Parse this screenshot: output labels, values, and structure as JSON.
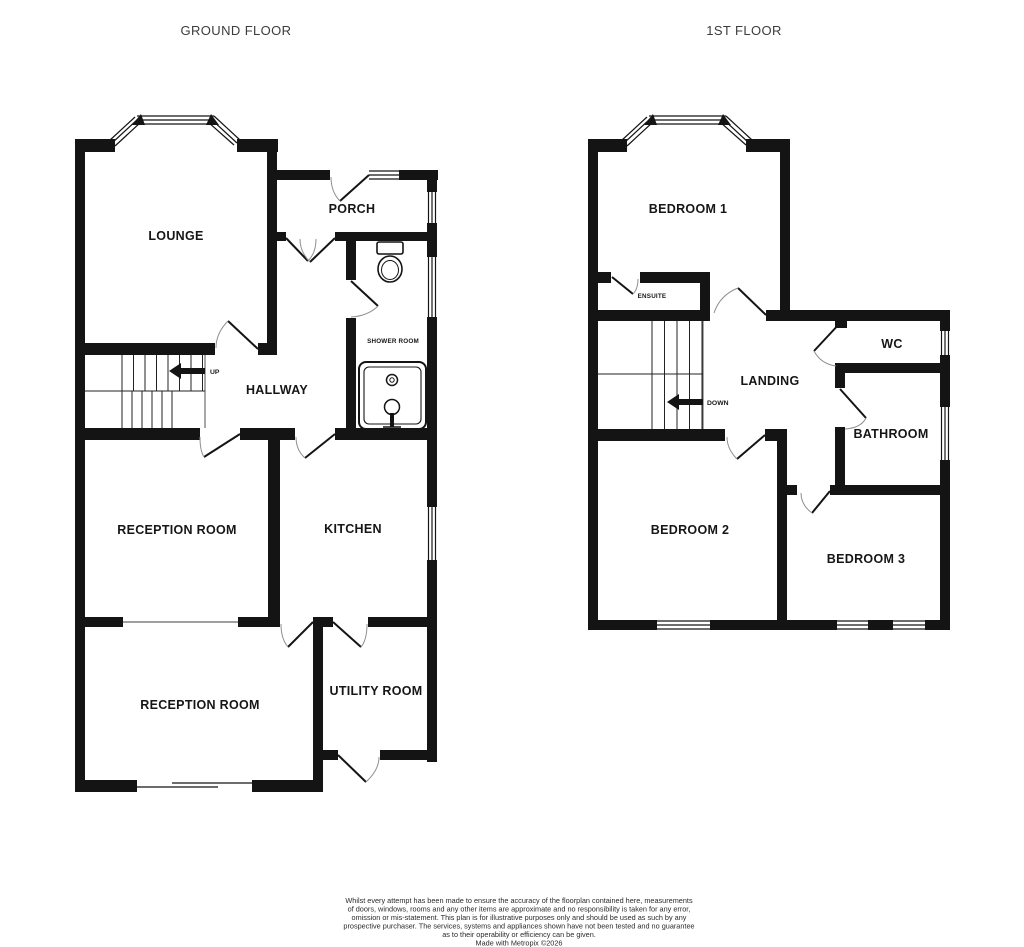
{
  "ground_floor": {
    "title": "GROUND FLOOR",
    "rooms": {
      "lounge": "LOUNGE",
      "porch": "PORCH",
      "hallway": "HALLWAY",
      "shower_room": "SHOWER ROOM",
      "reception_room_1": "RECEPTION ROOM",
      "kitchen": "KITCHEN",
      "reception_room_2": "RECEPTION ROOM",
      "utility_room": "UTILITY ROOM"
    },
    "stairs_label": "UP"
  },
  "first_floor": {
    "title": "1ST FLOOR",
    "rooms": {
      "bedroom_1": "BEDROOM 1",
      "ensuite": "ENSUITE",
      "landing": "LANDING",
      "wc": "WC",
      "bathroom": "BATHROOM",
      "bedroom_2": "BEDROOM 2",
      "bedroom_3": "BEDROOM 3"
    },
    "stairs_label": "DOWN"
  },
  "disclaimer": {
    "lines": [
      "Whilst every attempt has been made to ensure the accuracy of the floorplan contained here, measurements",
      "of doors, windows, rooms and any other items are approximate and no responsibility is taken for any error,",
      "omission or mis-statement. This plan is for illustrative purposes only and should be used as such by any",
      "prospective purchaser. The services, systems and appliances shown have not been tested and no guarantee",
      "as to their operability or efficiency can be given.",
      "Made with Metropix ©2026"
    ]
  },
  "colors": {
    "wall": "#141414",
    "door_arc": "#8f8f8f",
    "title_text": "#3c3c3c",
    "label_text": "#161616",
    "background": "#ffffff"
  }
}
